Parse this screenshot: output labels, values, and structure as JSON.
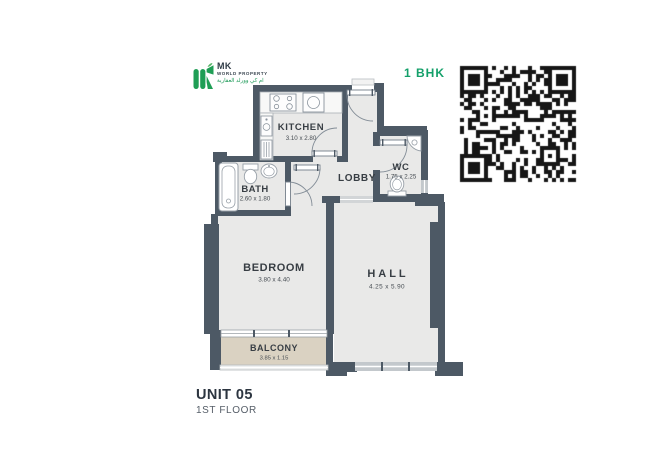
{
  "header": {
    "logo": {
      "mk": "MK",
      "subtitle": "WORLD PROPERTY",
      "arabic": "ام كي وورلد العقارية"
    },
    "unit_type": "1 BHK"
  },
  "floor_plan": {
    "rooms": {
      "kitchen": {
        "label": "KITCHEN",
        "dims": "3.10 x 2.80"
      },
      "lobby": {
        "label": "LOBBY",
        "dims": ""
      },
      "wc": {
        "label": "WC",
        "dims": "1.75 x 2.25"
      },
      "bath": {
        "label": "BATH",
        "dims": "2.60 x 1.80"
      },
      "bedroom": {
        "label": "BEDROOM",
        "dims": "3.80 x 4.40"
      },
      "hall": {
        "label": "HALL",
        "dims": "4.25 x 5.90"
      },
      "balcony": {
        "label": "BALCONY",
        "dims": "3.85 x 1.15"
      }
    }
  },
  "footer": {
    "unit": "UNIT 05",
    "floor": "1ST FLOOR"
  },
  "colors": {
    "wall": "#4d5965",
    "floor": "#e9e9e8",
    "balcony_floor": "#dad2c2",
    "accent_green": "#14a06a",
    "qr": "#161616"
  }
}
